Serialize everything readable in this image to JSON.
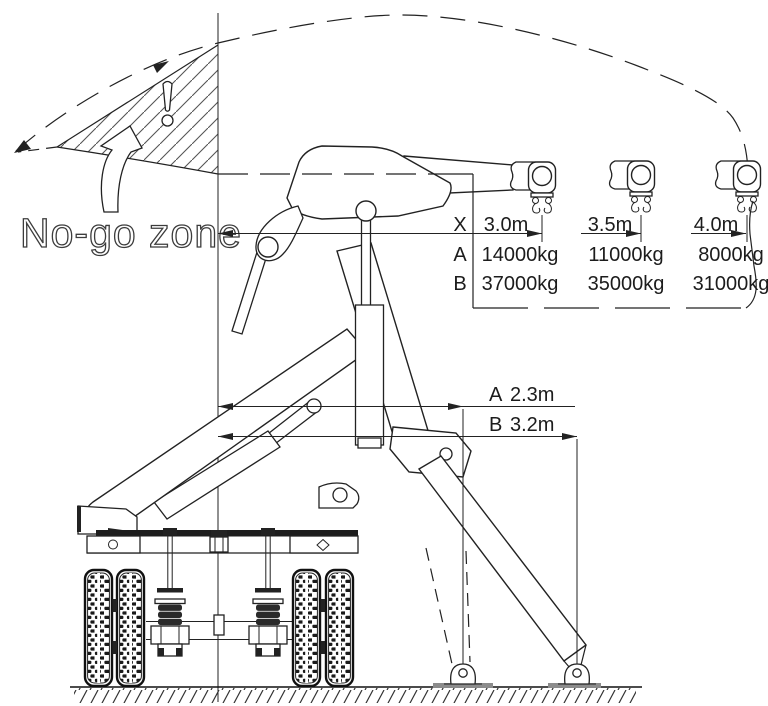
{
  "no_go_zone": {
    "label": "No-go zone"
  },
  "load_table": {
    "rows": [
      {
        "label": "X",
        "values": [
          "3.0m",
          "3.5m",
          "4.0m"
        ]
      },
      {
        "label": "A",
        "values": [
          "14000kg",
          "11000kg",
          "8000kg"
        ]
      },
      {
        "label": "B",
        "values": [
          "37000kg",
          "35000kg",
          "31000kg"
        ]
      }
    ]
  },
  "dimensions": {
    "a": {
      "label": "A",
      "value": "2.3m"
    },
    "b": {
      "label": "B",
      "value": "3.2m"
    }
  },
  "colors": {
    "line": "#222222",
    "background": "#ffffff",
    "pad": "#8c8c8c"
  }
}
